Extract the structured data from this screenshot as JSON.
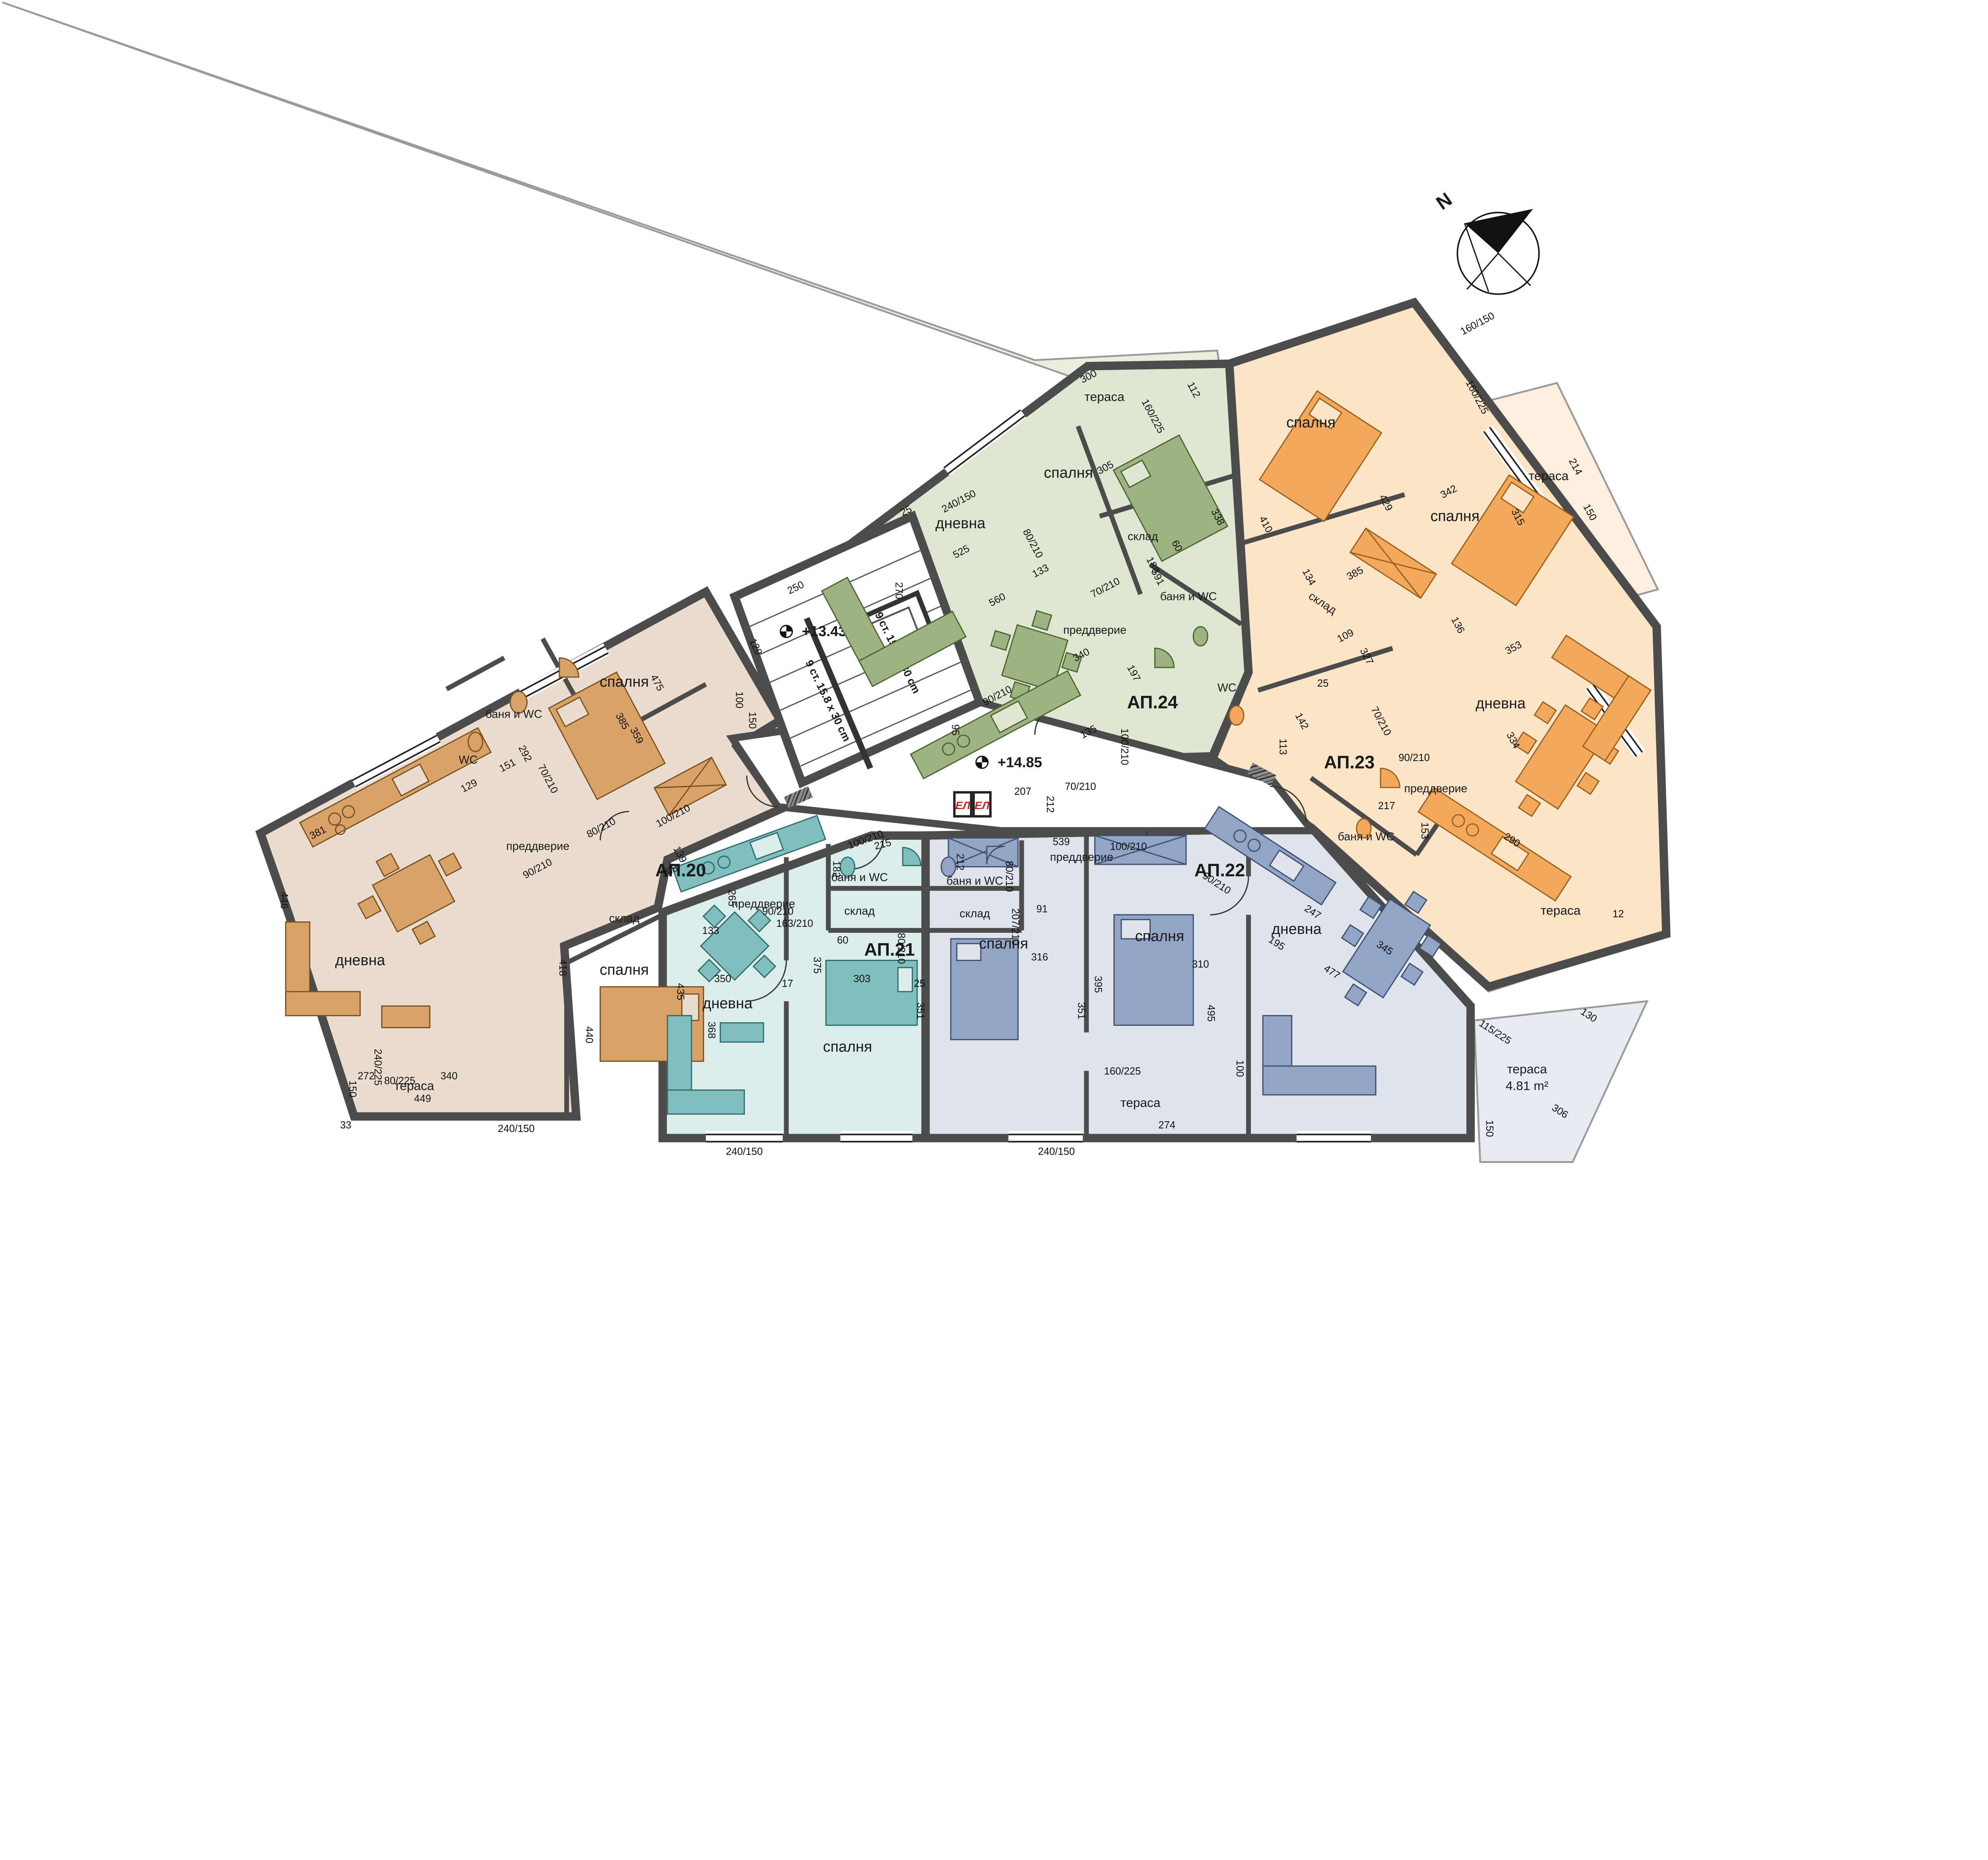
{
  "compass": {
    "label": "N"
  },
  "core": {
    "stair_level": "+13.43",
    "corridor_level": "+14.85",
    "flight_note_a": "9 ст. 15.8 x 30 cm",
    "flight_note_b": "9 ст. 15.8 x 30 cm",
    "shaft_a": "ЕЛ",
    "shaft_b": "ЕЛ",
    "dims": [
      "250",
      "120",
      "25",
      "100",
      "150",
      "207",
      "212",
      "70/210"
    ]
  },
  "apartments": [
    {
      "id": "АП.20",
      "rooms": {
        "living": "дневна",
        "bedroom1": "спалня",
        "bedroom2": "спалня",
        "bath": "баня и WC",
        "wc": "WC",
        "hall": "преддверие",
        "storage": "склад",
        "terrace": "тераса"
      },
      "dims": [
        "449",
        "418",
        "446",
        "381",
        "340",
        "368",
        "440",
        "272",
        "150",
        "240/225",
        "80/225",
        "475",
        "385",
        "359",
        "151",
        "129",
        "292",
        "308",
        "139",
        "90/210",
        "70/210",
        "80/210",
        "100/210",
        "33",
        "240/150"
      ]
    },
    {
      "id": "АП.21",
      "rooms": {
        "living": "дневна",
        "bedroom": "спалня",
        "bath": "баня и WC",
        "hall": "преддверие",
        "storage": "склад"
      },
      "dims": [
        "350",
        "435",
        "375",
        "303",
        "351",
        "215",
        "265",
        "133",
        "163/210",
        "182",
        "60",
        "17",
        "25",
        "90/210",
        "100/210",
        "80/210",
        "240/150"
      ]
    },
    {
      "id": "АП.22",
      "rooms": {
        "living": "дневна",
        "bedroom1": "спалня",
        "bedroom2": "спалня",
        "bath": "баня и WC",
        "hall": "преддверие",
        "storage": "склад",
        "terrace1": "тераса",
        "terrace2": "тераса",
        "terrace2_area": "4.81 m²"
      },
      "dims": [
        "539",
        "316",
        "395",
        "495",
        "310",
        "351",
        "207/210",
        "212",
        "91",
        "247",
        "477",
        "345",
        "274",
        "160/225",
        "100",
        "115/225",
        "306",
        "150",
        "90/210",
        "100/210",
        "80/210",
        "240/150",
        "195"
      ]
    },
    {
      "id": "АП.23",
      "rooms": {
        "living": "дневна",
        "bedroom1": "спалня",
        "bedroom2": "спалня",
        "bath": "баня и WC",
        "wc": "WC",
        "hall": "преддверие",
        "storage": "склад",
        "terrace1": "тераса",
        "terrace2": "тераса"
      },
      "dims": [
        "429",
        "385",
        "342",
        "315",
        "334",
        "217",
        "153",
        "290",
        "109",
        "327",
        "134",
        "142",
        "113",
        "136",
        "353",
        "214",
        "150",
        "160/225",
        "160/150",
        "130",
        "70/210",
        "90/210",
        "25",
        "12"
      ]
    },
    {
      "id": "АП.24",
      "rooms": {
        "living": "дневна",
        "bedroom": "спалня",
        "bath": "баня и WC",
        "hall": "преддверие",
        "storage": "склад",
        "terrace": "тераса"
      },
      "dims": [
        "525",
        "560",
        "591",
        "340",
        "305",
        "338",
        "270",
        "300",
        "112",
        "160/225",
        "95",
        "135",
        "100/210",
        "133",
        "197",
        "180",
        "60",
        "80/210",
        "70/210",
        "90/210",
        "240/150",
        "410"
      ]
    }
  ],
  "colors": {
    "wall": "#4c4c4c",
    "wall_edge": "#111111",
    "ap20_floor": "#eadcce",
    "ap20_accent": "#d9a368",
    "ap21_floor": "#ddedeb",
    "ap21_accent": "#7fbfbd",
    "ap22_floor": "#dfe3ec",
    "ap22_accent": "#93a5c6",
    "ap23_floor": "#fce4c6",
    "ap23_accent": "#f2a95c",
    "ap24_floor": "#dfe7d3",
    "ap24_accent": "#9db381",
    "shaft_red": "#cc2222"
  }
}
